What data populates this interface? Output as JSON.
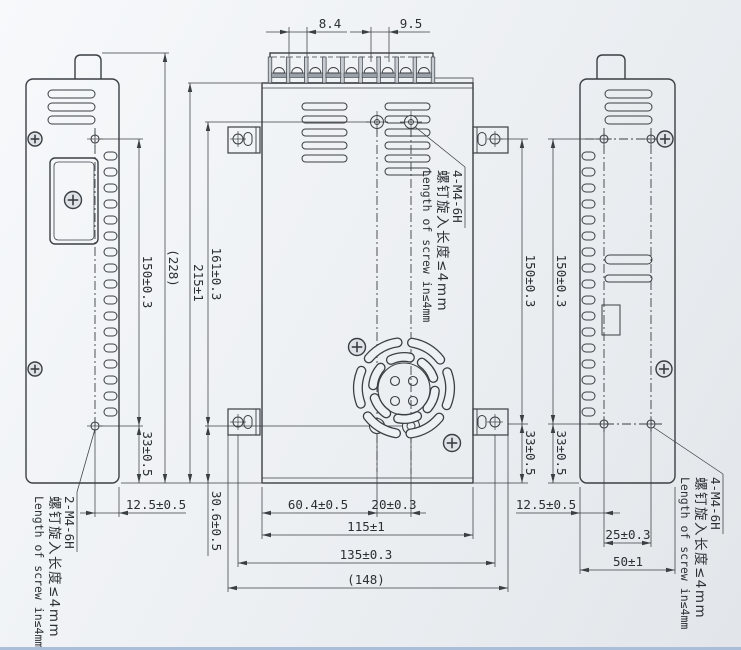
{
  "drawing": {
    "dims": {
      "terminal_slot_width": "8.4",
      "terminal_pitch": "9.5",
      "left_screw_span": "150±0.3",
      "left_overall_height": "(228)",
      "case_height": "215±1",
      "top_screw_span": "161±0.3",
      "screw_to_bottom": "30.6±0.5",
      "left_foot_height": "33±0.5",
      "left_screw_inset": "12.5±0.5",
      "fan_screw_offset": "60.4±0.5",
      "fan_screw_pitch": "20±0.3",
      "case_width": "115±1",
      "ear_hole_span": "135±0.3",
      "overall_width": "(148)",
      "ear_screw_span": "150±0.3",
      "right_screw_span": "150±0.3",
      "ear_foot_height": "33±0.5",
      "right_foot_height": "33±0.5",
      "right_screw_inset": "12.5±0.5",
      "right_screw_pitch": "25±0.3",
      "right_depth": "50±1"
    },
    "notes": {
      "left": {
        "title": "2-M4-6H",
        "cn": "螺钉旋入长度≤4mm",
        "en": "Length of screw in≤4mm"
      },
      "center": {
        "title": "4-M4-6H",
        "cn": "螺钉旋入长度≤4mm",
        "en": "Length of screw in≤4mm"
      },
      "right": {
        "title": "4-M4-6H",
        "cn": "螺钉旋入长度≤4mm",
        "en": "Length of screw in≤4mm"
      }
    },
    "colors": {
      "line": "#3a3f44",
      "text": "#2b3035",
      "edge": "#aabeda"
    }
  }
}
